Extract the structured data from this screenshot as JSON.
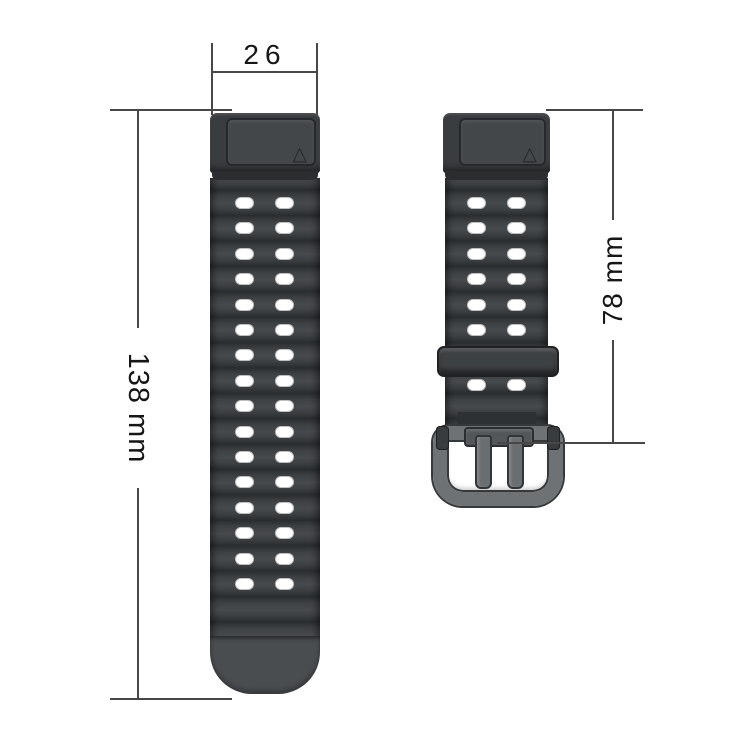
{
  "labels": {
    "strap_width": "26",
    "long_strap_length": "138 mm",
    "short_strap_length": "78 mm"
  },
  "long_strap": {
    "hole_rows": 16,
    "hole_columns": 2
  },
  "short_strap": {
    "hole_rows_above_keeper": 6,
    "hole_rows_below_keeper": 1,
    "hole_columns": 2
  },
  "colors": {
    "strap_body": "#3b3e41",
    "strap_stripe_dark": "#2a2d30",
    "strap_stripe_light": "#474a4d",
    "connector_plate": "#44474a",
    "buckle_gray": "#6f7274",
    "hole_fill": "#ffffff",
    "dimension_line": "#474747"
  }
}
